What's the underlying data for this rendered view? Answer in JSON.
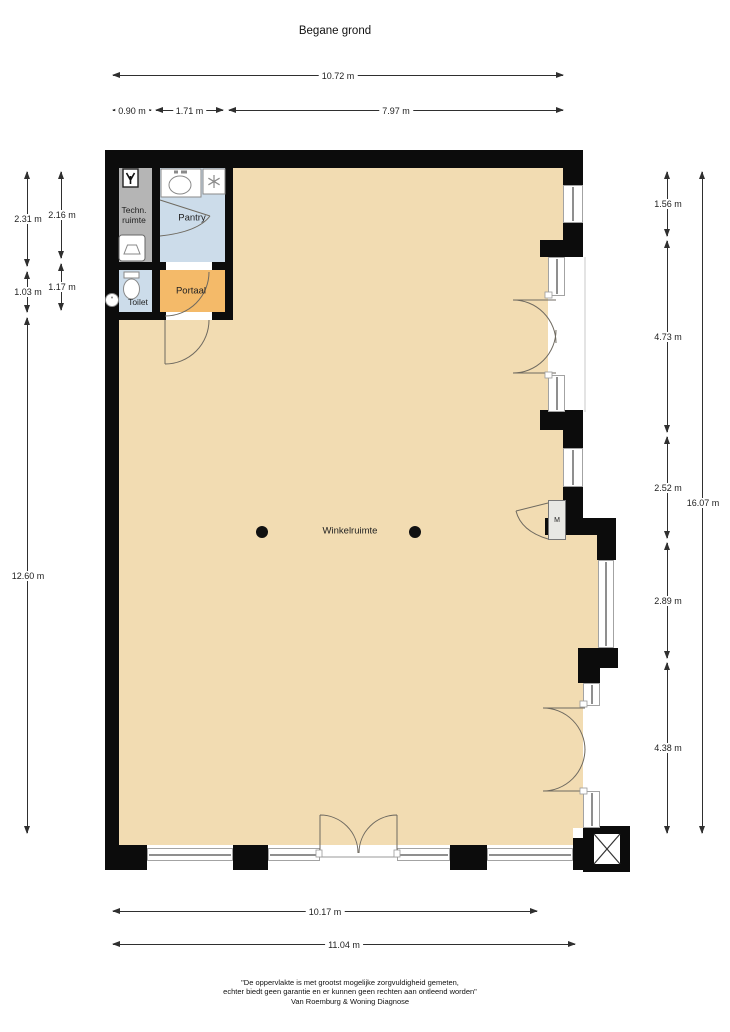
{
  "title": "Begane grond",
  "rooms": {
    "winkelruimte": "Winkelruimte",
    "pantry": "Pantry",
    "techn_ruimte": "Techn.\nruimte",
    "toilet": "Toilet",
    "portaal": "Portaal",
    "meterkast": "M"
  },
  "dimensions": {
    "top_total": "10.72 m",
    "top_seg1": "0.90 m",
    "top_seg2": "1.71 m",
    "top_seg3": "7.97 m",
    "left_outer_seg1": "2.31 m",
    "left_outer_seg2": "1.03 m",
    "left_outer_seg3": "12.60 m",
    "left_inner_seg1": "2.16 m",
    "left_inner_seg2": "1.17 m",
    "right_inner_seg1": "1.56 m",
    "right_inner_seg2": "4.73 m",
    "right_inner_seg3": "2.52 m",
    "right_inner_seg4": "2.89 m",
    "right_inner_seg5": "4.38 m",
    "right_total": "16.07 m",
    "bottom_inner": "10.17 m",
    "bottom_total": "11.04 m"
  },
  "footer": {
    "line1": "\"De oppervlakte is met grootst mogelijke zorgvuldigheid gemeten,",
    "line2": "echter biedt geen garantie en er kunnen geen rechten aan ontleend worden\"",
    "line3": "Van Roemburg & Woning Diagnose"
  },
  "colors": {
    "shop_floor": "#f2dcb2",
    "wet_rooms": "#ccdcea",
    "portaal": "#f4ba69",
    "technical_room": "#b5b5b5",
    "wall": "#0c0c0c",
    "window_frame": "#8f8f8f",
    "dimension_line": "#2f2f2f"
  },
  "icons": {
    "electric_meter": "arrow-down-glyph",
    "boiler": "trapezoid-in-rounded-box",
    "sink": "oval-basin-with-taps",
    "freezer": "snowflake-asterisk",
    "toilet": "bowl-with-cistern",
    "hand_basin": "small-circle",
    "structural_column": "filled-black-dot",
    "elevator_shaft": "box-with-x-cross"
  }
}
